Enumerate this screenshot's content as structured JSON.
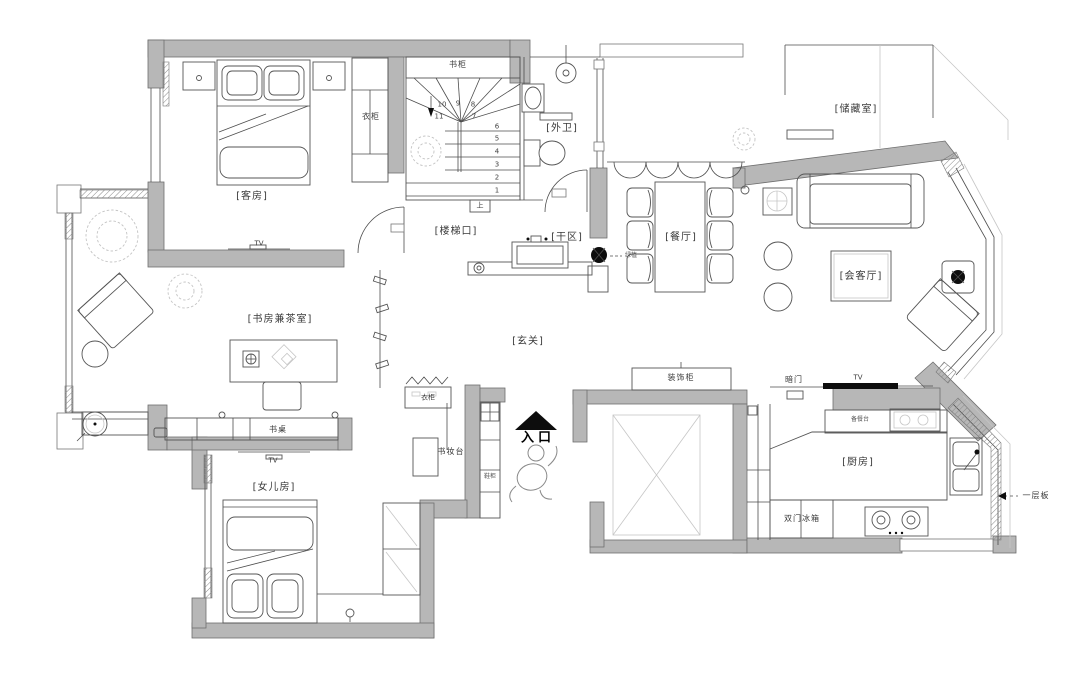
{
  "title": "apartment-floor-plan",
  "colors": {
    "wall": "#b7b7b7",
    "line": "#4d4d4d",
    "black": "#000000"
  },
  "rooms": {
    "guest_room": "[客房]",
    "outer_bath": "[外卫]",
    "storage": "[储藏室]",
    "stair_hall": "[楼梯口]",
    "dry_area": "[干区]",
    "dining": "[餐厅]",
    "reception": "[会客厅]",
    "foyer": "[玄关]",
    "study_tea": "[书房兼茶室]",
    "daughter_room": "[女儿房]",
    "kitchen": "[厨房]"
  },
  "labels": {
    "bookcase": "书柜",
    "wardrobe": "衣柜",
    "desk": "书桌",
    "entry_wardrobe": "衣柜",
    "vanity": "书妆台",
    "shoe_cabinet": "鞋柜",
    "entrance": "入口",
    "deco_cabinet": "装饰柜",
    "hidden_door": "暗门",
    "serving_counter": "备餐台",
    "double_door_fridge": "双门冰箱",
    "shelf_board": "一层板",
    "up": "上",
    "tv": "TV",
    "plant": "绿植"
  },
  "stairs": {
    "numbers": [
      "1",
      "2",
      "3",
      "4",
      "5",
      "6",
      "7",
      "8",
      "9",
      "10",
      "11"
    ]
  }
}
